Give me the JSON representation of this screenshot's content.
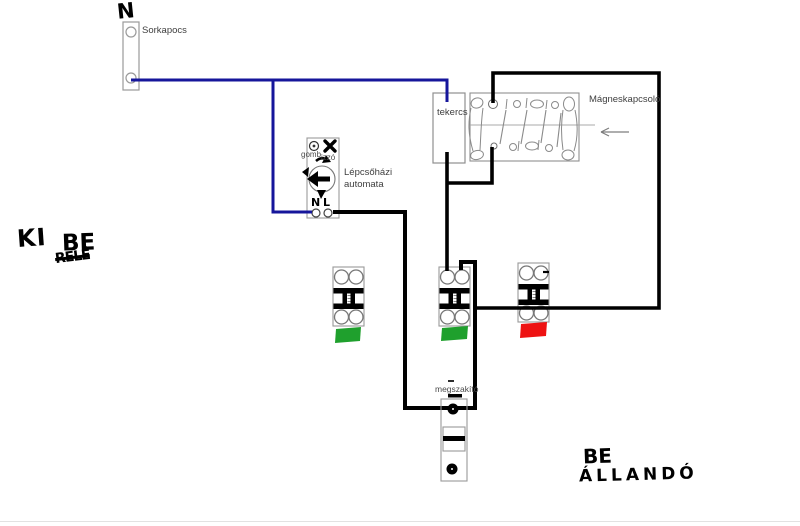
{
  "labels": {
    "neutral": "N",
    "terminal_block": "Sorkapocs",
    "automat_button": "gomb",
    "automat_bulb": "izzó",
    "automat_name_line1": "Lépcsőházi",
    "automat_name_line2": "automata",
    "automat_n": "N",
    "automat_l": "L",
    "coil": "tekercs",
    "contactor": "Mágneskapcsoló",
    "disconnector": "megszakító"
  },
  "handwriting": {
    "off": "KI",
    "on": "BE",
    "scribble": "RELÉ",
    "on_bottom": "BE",
    "permanent": "ÁLLANDÓ"
  },
  "icons": {
    "button": "push-button-icon",
    "bulb": "bulb-icon",
    "timer": "timer-dial-arrow-icon",
    "pointer": "left-arrow-icon"
  },
  "colors": {
    "wire_neutral_blue": "#16169b",
    "wire_black": "#000000",
    "indicator_green": "#1fa02d",
    "indicator_red": "#ee1212",
    "outline_gray": "#979797"
  }
}
